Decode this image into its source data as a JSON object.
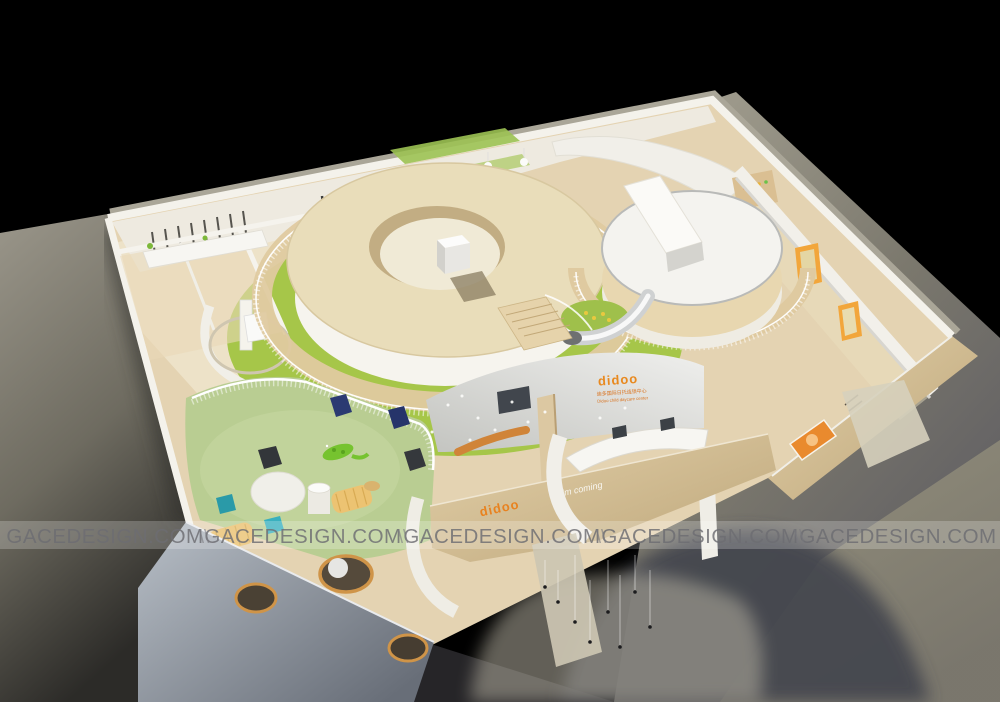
{
  "scene": {
    "description": "Bird's-eye 3D cutaway render of the didoo child daycare center interior on a black backdrop",
    "background": "#000000"
  },
  "watermark": {
    "text": "GACEDESIGN.COM",
    "separator": "\\\\",
    "count": 5
  },
  "signs": {
    "lobby_logo": "didoo",
    "lobby_line_cn": "迪多国际日托连锁中心",
    "lobby_line_en": "Didoo child daycare center",
    "entry_logo": "didoo",
    "entry_slogan": "I'm coming"
  },
  "palette": {
    "background": "#000000",
    "ground": "#8d8a7d",
    "wood_floor": "#e4d3b2",
    "cream_ring": "#e9ddba",
    "play_green": "#a6c649",
    "sage_mat": "#b9cd92",
    "accent_orange": "#e8821f",
    "door_orange": "#f2a63b",
    "wall_white": "#f3f1ea",
    "porthole_wall": "#9aa3ad",
    "teal_beanbag": "#2fa3b3",
    "navy_beanbag": "#27356b",
    "yellow_lounger": "#e8c06a"
  }
}
